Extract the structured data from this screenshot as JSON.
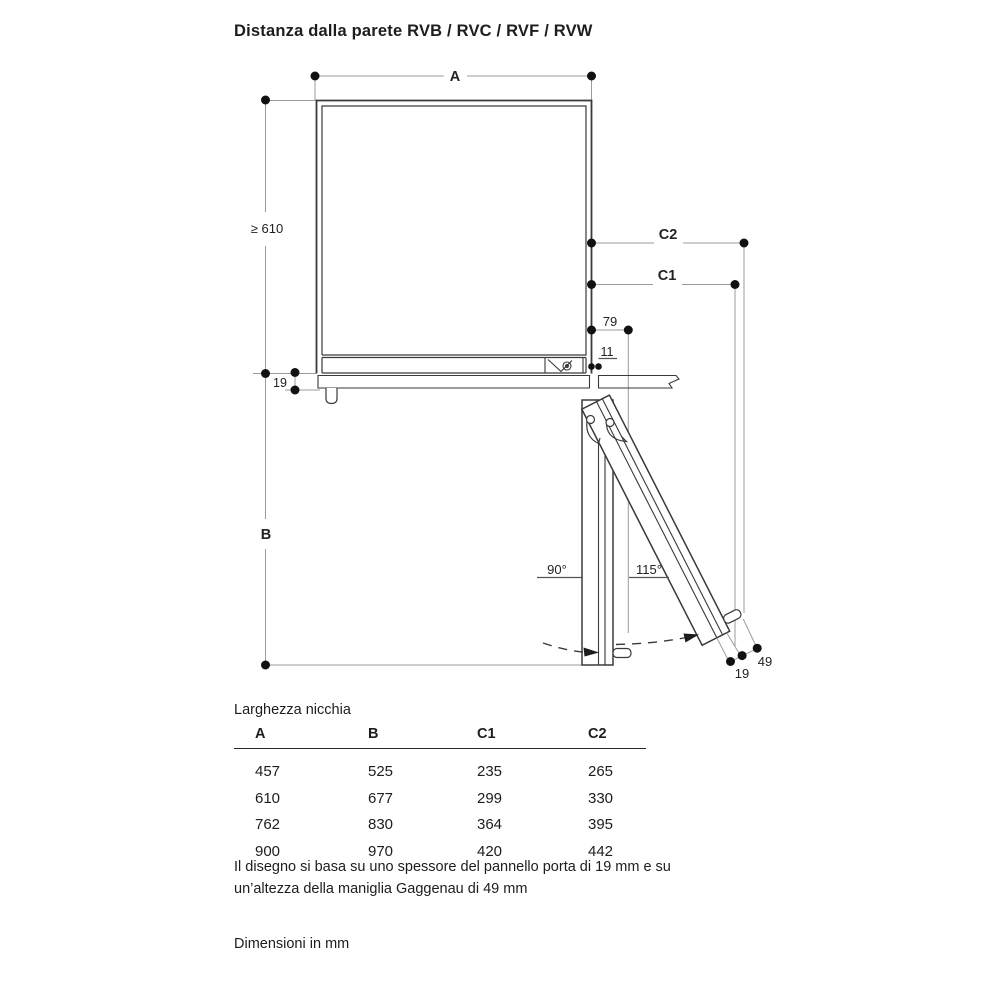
{
  "title": "Distanza dalla parete RVB / RVC / RVF / RVW",
  "diagram": {
    "labels": {
      "niche_width": "A",
      "niche_depth": "≥ 610",
      "clearance_c2": "C2",
      "clearance_c1": "C1",
      "hinge_offset": "79",
      "gap": "11",
      "panel_thickness": "19",
      "swing_depth": "B",
      "angle_open_90": "90°",
      "angle_open_115": "115°",
      "door_panel": "19",
      "handle_height": "49"
    },
    "line_color": "#3a3a3a",
    "dim_color": "#9b9b9b",
    "dot_color": "#111111"
  },
  "table": {
    "caption": "Larghezza nicchia",
    "headers": [
      "A",
      "B",
      "C1",
      "C2"
    ],
    "rows": [
      [
        "457",
        "525",
        "235",
        "265"
      ],
      [
        "610",
        "677",
        "299",
        "330"
      ],
      [
        "762",
        "830",
        "364",
        "395"
      ],
      [
        "900",
        "970",
        "420",
        "442"
      ]
    ]
  },
  "notes": {
    "line1": "Il disegno si basa su uno spessore del pannello porta di 19 mm e su",
    "line2": "un’altezza della maniglia Gaggenau di 49 mm",
    "units": "Dimensioni in mm"
  }
}
